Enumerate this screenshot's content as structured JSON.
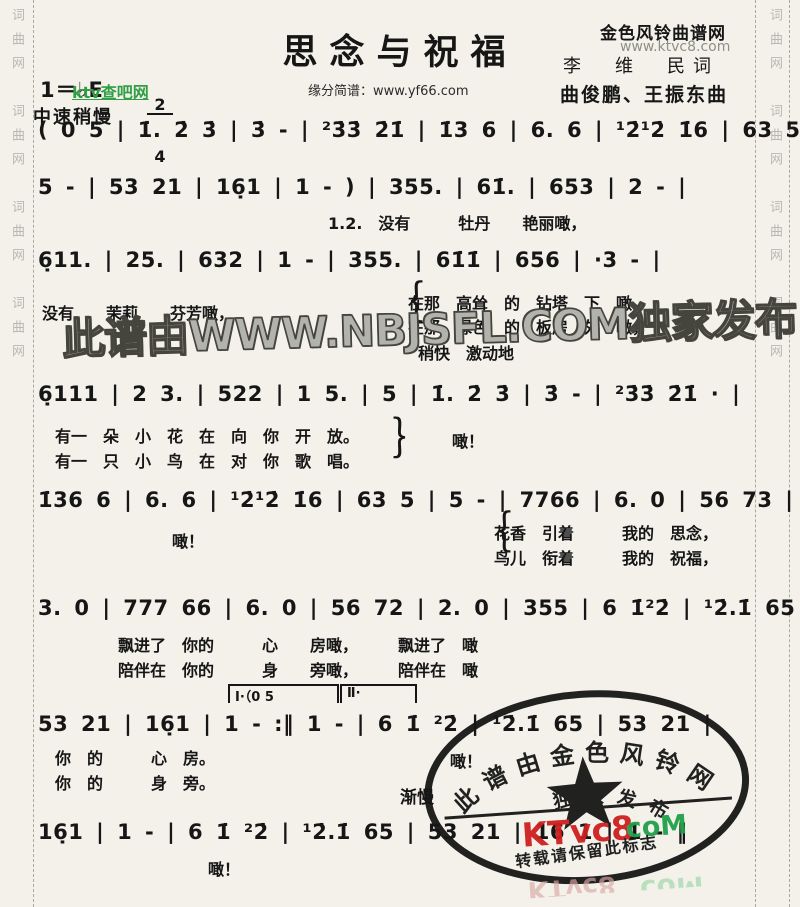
{
  "colors": {
    "paper": "#f3f1ea",
    "ink": "#161616",
    "green_link": "#2f9e44",
    "center_watermark_gray": "#b3b3ad",
    "stamp_red": "#cf1f1f",
    "stamp_green": "#21a04a",
    "margin_text_gray": "#b8b8b2"
  },
  "margins": {
    "left_column": "词曲网　词曲网　词曲网　词曲网",
    "right_column": "词曲网　词曲网　词曲网　词曲网"
  },
  "header": {
    "key_signature": "1＝♭E",
    "time_top": "2",
    "time_bottom": "4",
    "tempo": "中速稍慢",
    "green_watermark": "ktv查吧网",
    "title": "思念与祝福",
    "subtitle": "缘分简谱：www.yf66.com",
    "site_name": "金色风铃曲谱网",
    "site_url": "www.ktvc8.com",
    "lyricist": "李　维　民词",
    "composer": "曲俊鹏、王振东曲"
  },
  "watermark_center": "此谱由WWW.NBJSFL.COM独家发布",
  "systems": {
    "s1": {
      "n": "( 0 5 | 1̇. 2̇ 3̇ | 3̇ - | ²3̇3̇ 2̇1̇ | 1̇3 6 | 6. 6 | ¹2̇¹2̇ 1̇6 | 63 5 |"
    },
    "s2": {
      "n": "5 - | 53 21 | 16̣1 | 1 - ) | 355. | 61̇. | 653 | 2 - |",
      "a": "1.2.　没有　　　牡丹　　艳丽噉，"
    },
    "s3": {
      "n": "6̣11. | 25. | 632 | 1 - | 355. | 61̇1̇ | 656 | ·3 - |",
      "a": "没有　　茉莉　　芬芳噉，",
      "brace": "｛",
      "b": "在那　高耸　的　钻塔　下　噉，",
      "c": "在那　绿色　的　板房　外　噉，",
      "tempo": "稍快　激动地"
    },
    "s4": {
      "n": "6̣111 | 2 3. | 522 | 1 5. | 5 | 1̇. 2̇ 3̇ | 3̇ - | ²3̇3̇ 2̇1̇ · |",
      "a": "有一　朵　小　花　在　向　你　开　放。",
      "b": "有一　只　小　鸟　在　对　你　歌　唱。",
      "brace": "｝",
      "c": "噉！"
    },
    "s5": {
      "n": "1̇36 6 | 6. 6 | ¹2̇¹2̇ 1̇6 | 63 5 | 5 - | 7766 | 6. 0 | 56 73 |",
      "a": "噉！",
      "brace": "｛",
      "b": "花香　引着　　　我的　思念，",
      "c": "鸟儿　衔着　　　我的　祝福，"
    },
    "s6": {
      "n": "3. 0 | 777 66 | 6. 0 | 56 72 | 2. 0 | 355 | 6 1̇²2̇ | ¹2̇.1̇ 65 |",
      "a": "飘进了　你的　　　心　　房噉，　　　飘进了　噉",
      "b": "陪伴在　你的　　　身　　旁噉，　　　陪伴在　噉"
    },
    "s7": {
      "n": "53 21 | 16̣1 | 1 - :‖ 1 - | 6 1̇ ²2̇ | ¹2̇.1̇ 65 | 53 21 |",
      "v1": "Ⅰ·（0 5",
      "v2": "Ⅱ·",
      "a": "你　的　　　心　房。",
      "b": "你　的　　　身　旁。",
      "c": "噉！",
      "tempo": "渐慢"
    },
    "s8": {
      "n": "16̣1 | 1 - | 6 1̇ ²2̇ | ¹2̇.1̇ 65 | 53 21 | 16 1 | 1 - ‖",
      "a": "噉！"
    }
  },
  "stamp": {
    "arc_outer": "此谱由金色风铃网",
    "arc_inner": "独家发布",
    "star": "★",
    "brand_red": "KTvc8",
    "brand_green": "coM",
    "notice": "转载请保留此标志"
  }
}
